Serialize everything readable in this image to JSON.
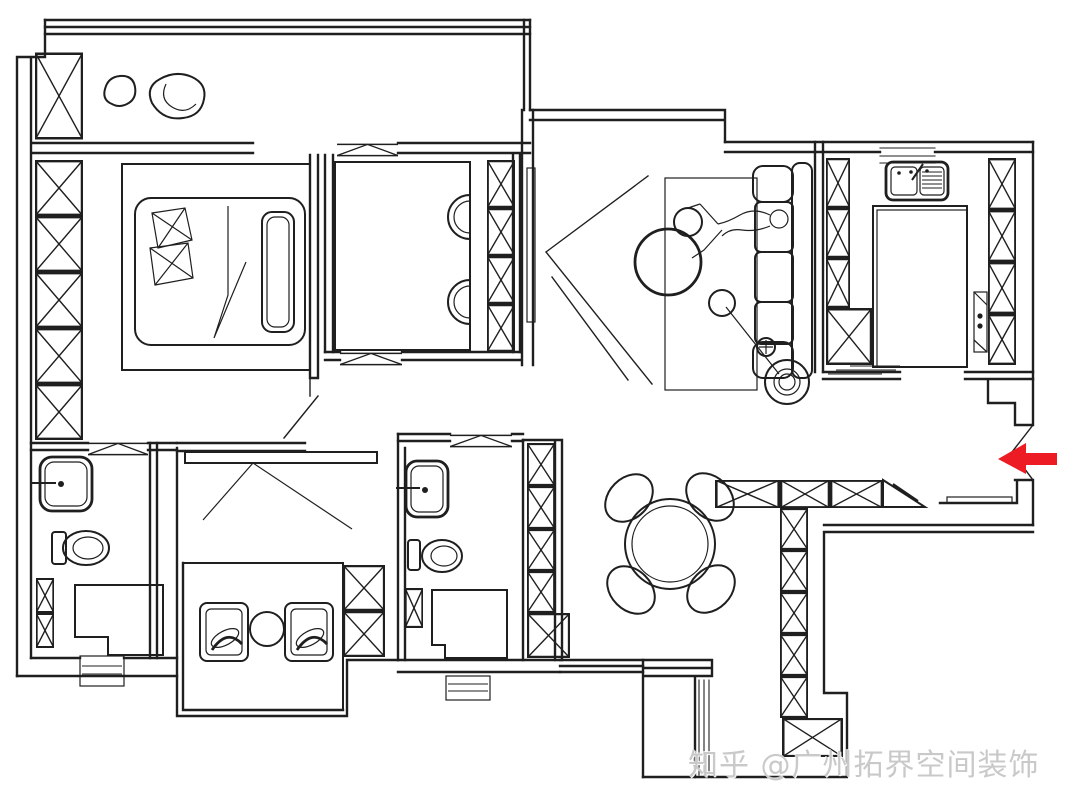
{
  "page": {
    "background": "#ffffff",
    "line_color": "#1f1f1f"
  },
  "watermark": {
    "text": "知乎 @广州拓界空间装饰",
    "color": "#c9c9c9"
  },
  "entry_arrow": {
    "color": "#ed1c24",
    "direction": "left",
    "meaning": "entrance"
  },
  "plan": {
    "type": "apartment-floor-plan",
    "rooms": [
      "balcony",
      "master-bedroom",
      "study",
      "hallway",
      "living-room",
      "kitchen",
      "dining-area",
      "entrance",
      "ensuite-bathroom",
      "bathroom",
      "tatami-bedroom"
    ],
    "fixtures": [
      "wardrobe-x-boxes",
      "bed",
      "pillows",
      "desk-with-chairs",
      "tv",
      "sofa",
      "person-lying",
      "coffee-tables",
      "floor-lamp",
      "rug",
      "kitchen-sink",
      "kitchen-island",
      "hob",
      "dining-table-4-chairs",
      "toilets",
      "wash-basins",
      "showers",
      "tatami-platform",
      "armchairs",
      "tea-table",
      "entry-cabinets",
      "plants"
    ]
  }
}
